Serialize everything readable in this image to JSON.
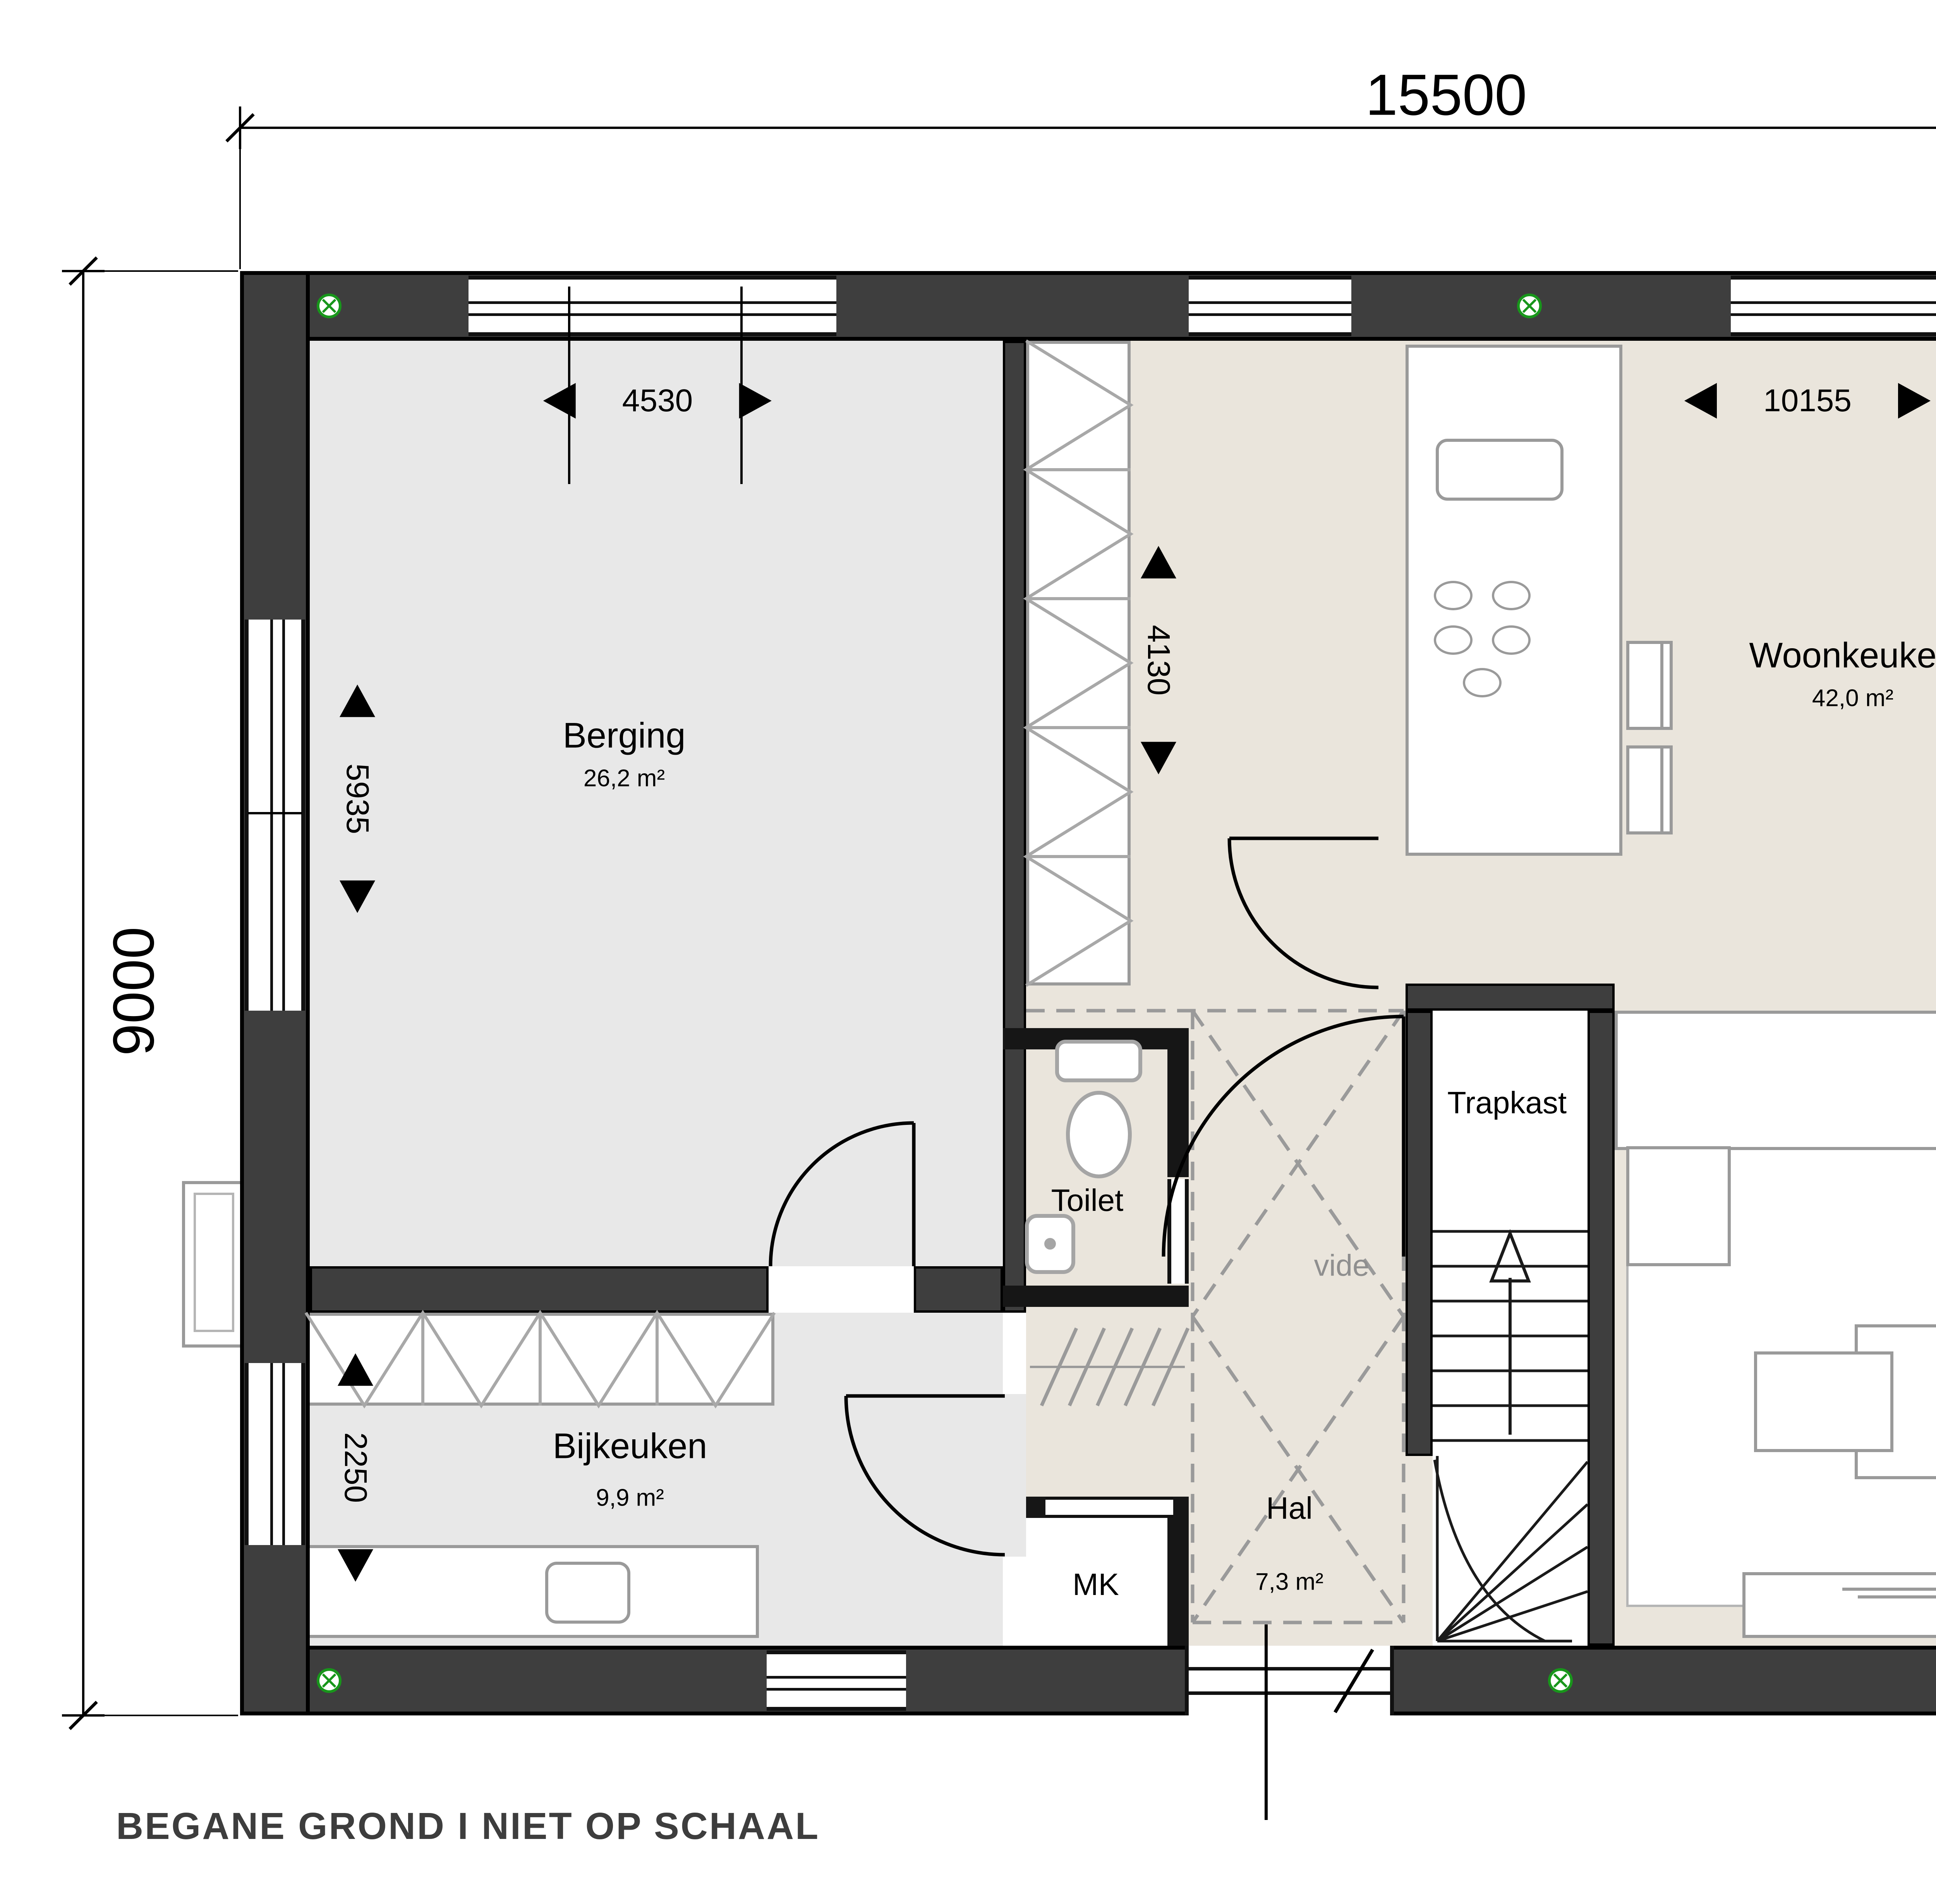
{
  "title": "BEGANE GROND I NIET OP SCHAAL",
  "dimensions": {
    "total_width": "15500",
    "total_height": "9000",
    "berging_width": "4530",
    "woonkeuken_width": "10155",
    "hall_depth": "4130",
    "berging_height": "5935",
    "right_side_height": "8310",
    "bijkeuken_height": "2250",
    "woonkamer_width": "6430"
  },
  "rooms": {
    "berging": {
      "name": "Berging",
      "area": "26,2 m²"
    },
    "bijkeuken": {
      "name": "Bijkeuken",
      "area": "9,9 m²"
    },
    "woonkeuken": {
      "name": "Woonkeuken",
      "area": "42,0 m²"
    },
    "woonkamer": {
      "name": "Woonkamer",
      "area": "26,5 m²"
    },
    "hal": {
      "name": "Hal",
      "area": "7,3 m²"
    },
    "toilet": {
      "name": "Toilet"
    },
    "trapkast": {
      "name": "Trapkast"
    },
    "mk": {
      "name": "MK"
    },
    "vide": {
      "name": "vide"
    }
  },
  "colors": {
    "wall": "#3e3e3e",
    "floor_gray": "#e8e8e8",
    "floor_beige": "#eae5dc",
    "furniture_line": "#9a9a9a",
    "vent_green": "#18961b",
    "title_text": "#3d3d3d"
  },
  "icons": {
    "vent": "ventilation-point-circle-x"
  }
}
